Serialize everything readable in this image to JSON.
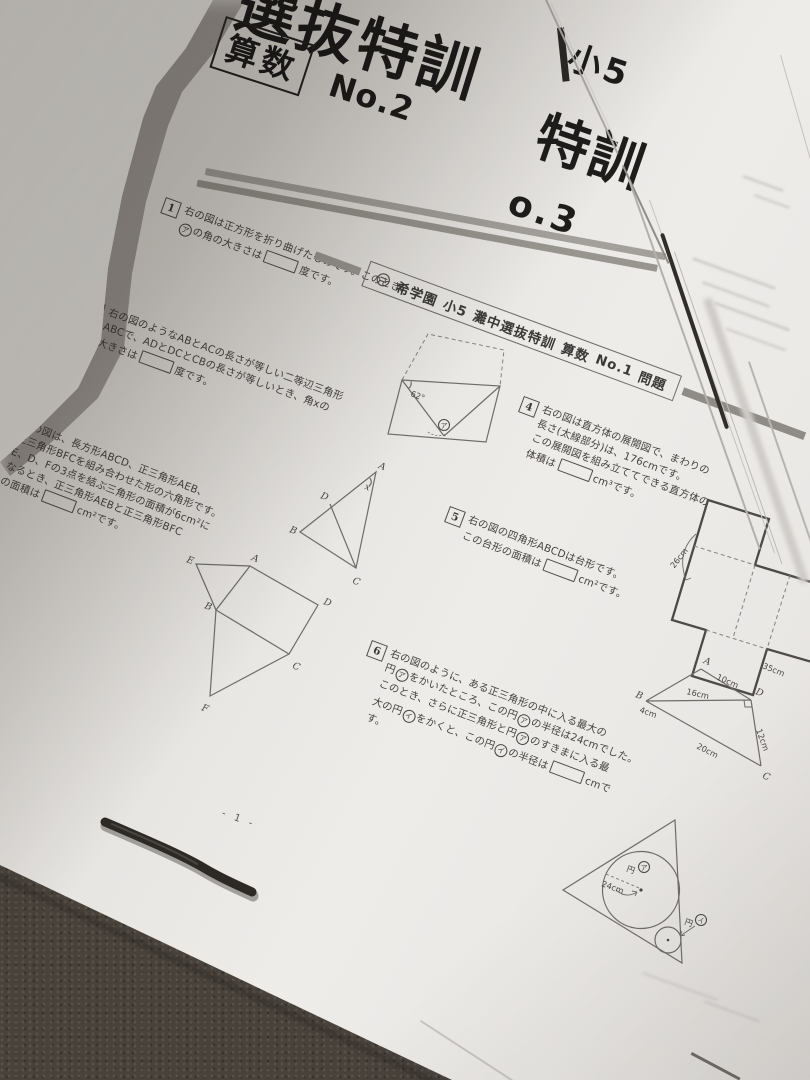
{
  "colors": {
    "carpet": "#48423b",
    "paper": "#e9e7e4",
    "shadow": "#cfccc8",
    "rule_gray": "#9a9792",
    "ink": "#3b3937"
  },
  "chars": {
    "a": "ア",
    "i": "イ"
  },
  "sheet_no2": {
    "title_large": "選抜特訓",
    "subject": "算数",
    "number": "No.2",
    "page_number": "- 1 -",
    "p1": {
      "num": "1",
      "l1": "右の図は正方形を折り曲げたものです。このとき、",
      "l2_mid": "の角の大きさは",
      "l2_end": "度です。"
    },
    "p2": {
      "num": "2",
      "l1": "右の図のようなABとACの長さが等しい二等辺三角形",
      "l2": "ABCで、ADとDCとCBの長さが等しいとき、角xの",
      "l3_pre": "大きさは",
      "l3_end": "度です。"
    },
    "p3": {
      "num": "3",
      "l1": "右の図は、長方形ABCD、正三角形AEB、",
      "l2": "正三角形BFCを組み合わせた形の六角形です。",
      "l3": "E、D、Fの3点を結ぶ三角形の面積が6cm²に",
      "l4": "なるとき、正三角形AEBと正三角形BFC",
      "l5_pre": "の面積は",
      "l5_end": "cm²です。"
    },
    "d1": {
      "angle": "62°"
    },
    "d2": {
      "A": "A",
      "B": "B",
      "C": "C",
      "D": "D",
      "x": "x"
    },
    "d3": {
      "A": "A",
      "B": "B",
      "C": "C",
      "D": "D",
      "E": "E",
      "F": "F"
    }
  },
  "sheet_no3": {
    "grade": "小5",
    "title_large": "特訓",
    "number_partial": "o.3"
  },
  "sheet_no1": {
    "header": {
      "logo_icon": "kibogakuen-logo",
      "school": "希学園",
      "grade": "小5",
      "course": "灘中選抜特訓",
      "subject": "算数",
      "number": "No.1",
      "section": "問題"
    },
    "p4": {
      "num": "4",
      "l1": "右の図は直方体の展開図で、まわりの",
      "l2": "長さ(太線部分)は、176cmです。",
      "l3": "この展開図を組み立ててできる直方体の",
      "l4_pre": "体積は",
      "l4_end": "cm³です。"
    },
    "p5": {
      "num": "5",
      "l1": "右の図の四角形ABCDは台形です。",
      "l2_pre": "この台形の面積は",
      "l2_end": "cm²です。"
    },
    "p6": {
      "num": "6",
      "l1": "右の図のように、ある正三角形の中に入る最大の",
      "l2a": "円",
      "l2b": "をかいたところ、この円",
      "l2c": "の半径は24cmでした。",
      "l3a": "このとき、さらに正三角形と円",
      "l3b": "のすきまに入る最",
      "l4a": "大の円",
      "l4b": "をかくと、この円",
      "l4c": "の半径は",
      "l4d": "cmで",
      "l5": "す。"
    },
    "d4": {
      "side": "26cm",
      "bottom": "35cm"
    },
    "d5": {
      "A": "A",
      "B": "B",
      "C": "C",
      "D": "D",
      "AD": "10cm",
      "BD": "16cm",
      "AB": "4cm",
      "BC": "20cm",
      "DC": "12cm"
    },
    "d6": {
      "big_label": "円",
      "radius": "24cm",
      "small_label": "円"
    }
  }
}
